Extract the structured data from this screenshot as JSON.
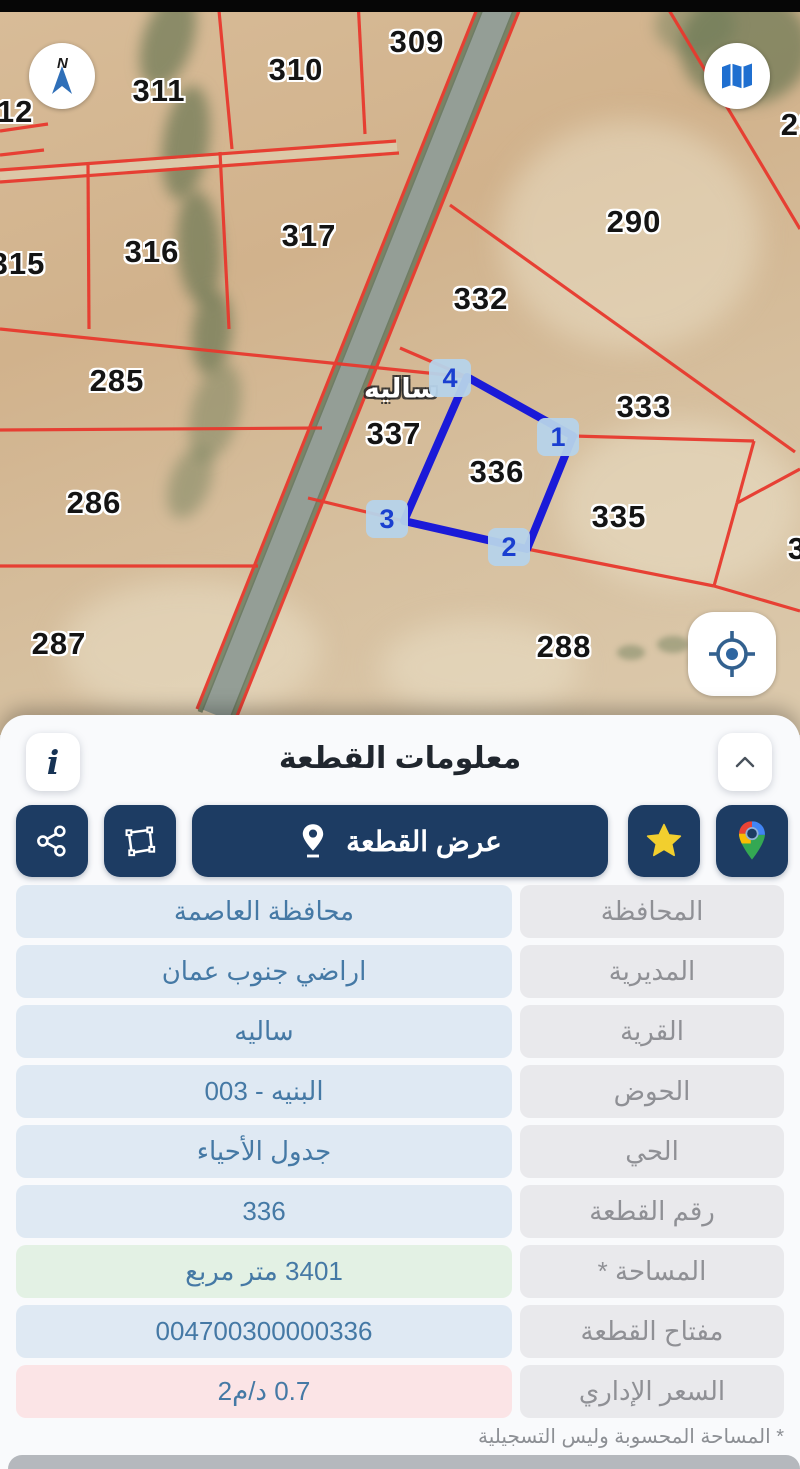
{
  "map": {
    "region_name_label": "ساليه",
    "parcel_labels": [
      {
        "text": "309",
        "x": 417,
        "y": 42
      },
      {
        "text": "310",
        "x": 296,
        "y": 70
      },
      {
        "text": "311",
        "x": 159,
        "y": 91
      },
      {
        "text": "312",
        "x": 6,
        "y": 112
      },
      {
        "text": "29",
        "x": 799,
        "y": 125
      },
      {
        "text": "315",
        "x": 18,
        "y": 264
      },
      {
        "text": "316",
        "x": 152,
        "y": 252
      },
      {
        "text": "317",
        "x": 309,
        "y": 236
      },
      {
        "text": "290",
        "x": 634,
        "y": 222
      },
      {
        "text": "332",
        "x": 481,
        "y": 299
      },
      {
        "text": "285",
        "x": 117,
        "y": 381
      },
      {
        "text": "333",
        "x": 644,
        "y": 407
      },
      {
        "text": "337",
        "x": 394,
        "y": 434
      },
      {
        "text": "336",
        "x": 497,
        "y": 472
      },
      {
        "text": "286",
        "x": 94,
        "y": 503
      },
      {
        "text": "335",
        "x": 619,
        "y": 517
      },
      {
        "text": "3",
        "x": 797,
        "y": 549
      },
      {
        "text": "287",
        "x": 59,
        "y": 644
      },
      {
        "text": "288",
        "x": 564,
        "y": 647
      }
    ],
    "village_label": {
      "text": "ساليه",
      "x": 401,
      "y": 389
    },
    "selected_parcel": {
      "number": "336",
      "points": [
        [
          467,
          377
        ],
        [
          573,
          436
        ],
        [
          527,
          549
        ],
        [
          404,
          521
        ]
      ],
      "vertex_labels": [
        {
          "text": "4",
          "x": 450,
          "y": 378
        },
        {
          "text": "1",
          "x": 558,
          "y": 437
        },
        {
          "text": "2",
          "x": 509,
          "y": 547
        },
        {
          "text": "3",
          "x": 387,
          "y": 519
        }
      ]
    },
    "compass_letter": "N",
    "colors": {
      "boundary_red": "#e8392e",
      "highlight_blue": "#1a1ad8",
      "vertex_pill_bg": "#b6d3ea",
      "vertex_pill_text": "#1a3fd0"
    }
  },
  "panel": {
    "title": "معلومات القطعة",
    "info_button_glyph": "i",
    "view_parcel_label": "عرض القطعة",
    "rows": [
      {
        "label": "المحافظة",
        "value": "محافظة العاصمة",
        "variant": "default"
      },
      {
        "label": "المديرية",
        "value": "اراضي جنوب عمان",
        "variant": "default"
      },
      {
        "label": "القرية",
        "value": "ساليه",
        "variant": "default"
      },
      {
        "label": "الحوض",
        "value": "البنيه - 003",
        "variant": "default"
      },
      {
        "label": "الحي",
        "value": "جدول الأحياء",
        "variant": "default"
      },
      {
        "label": "رقم القطعة",
        "value": "336",
        "variant": "default"
      },
      {
        "label": "المساحة *",
        "value": "3401  متر مربع",
        "variant": "area"
      },
      {
        "label": "مفتاح القطعة",
        "value": "004700300000336",
        "variant": "default"
      },
      {
        "label": "السعر الإداري",
        "value": "0.7 د/م2",
        "variant": "price"
      }
    ],
    "footnote": "* المساحة المحسوبة وليس التسجيلية",
    "colors": {
      "button_navy": "#1d3c63",
      "value_bg": "#dfe9f3",
      "value_text": "#4579a5",
      "label_bg": "#e9e9ec",
      "label_text": "#8f9095",
      "area_bg": "#e3f1e4",
      "price_bg": "#fbe4e6",
      "star_yellow": "#f2cf2e"
    }
  }
}
